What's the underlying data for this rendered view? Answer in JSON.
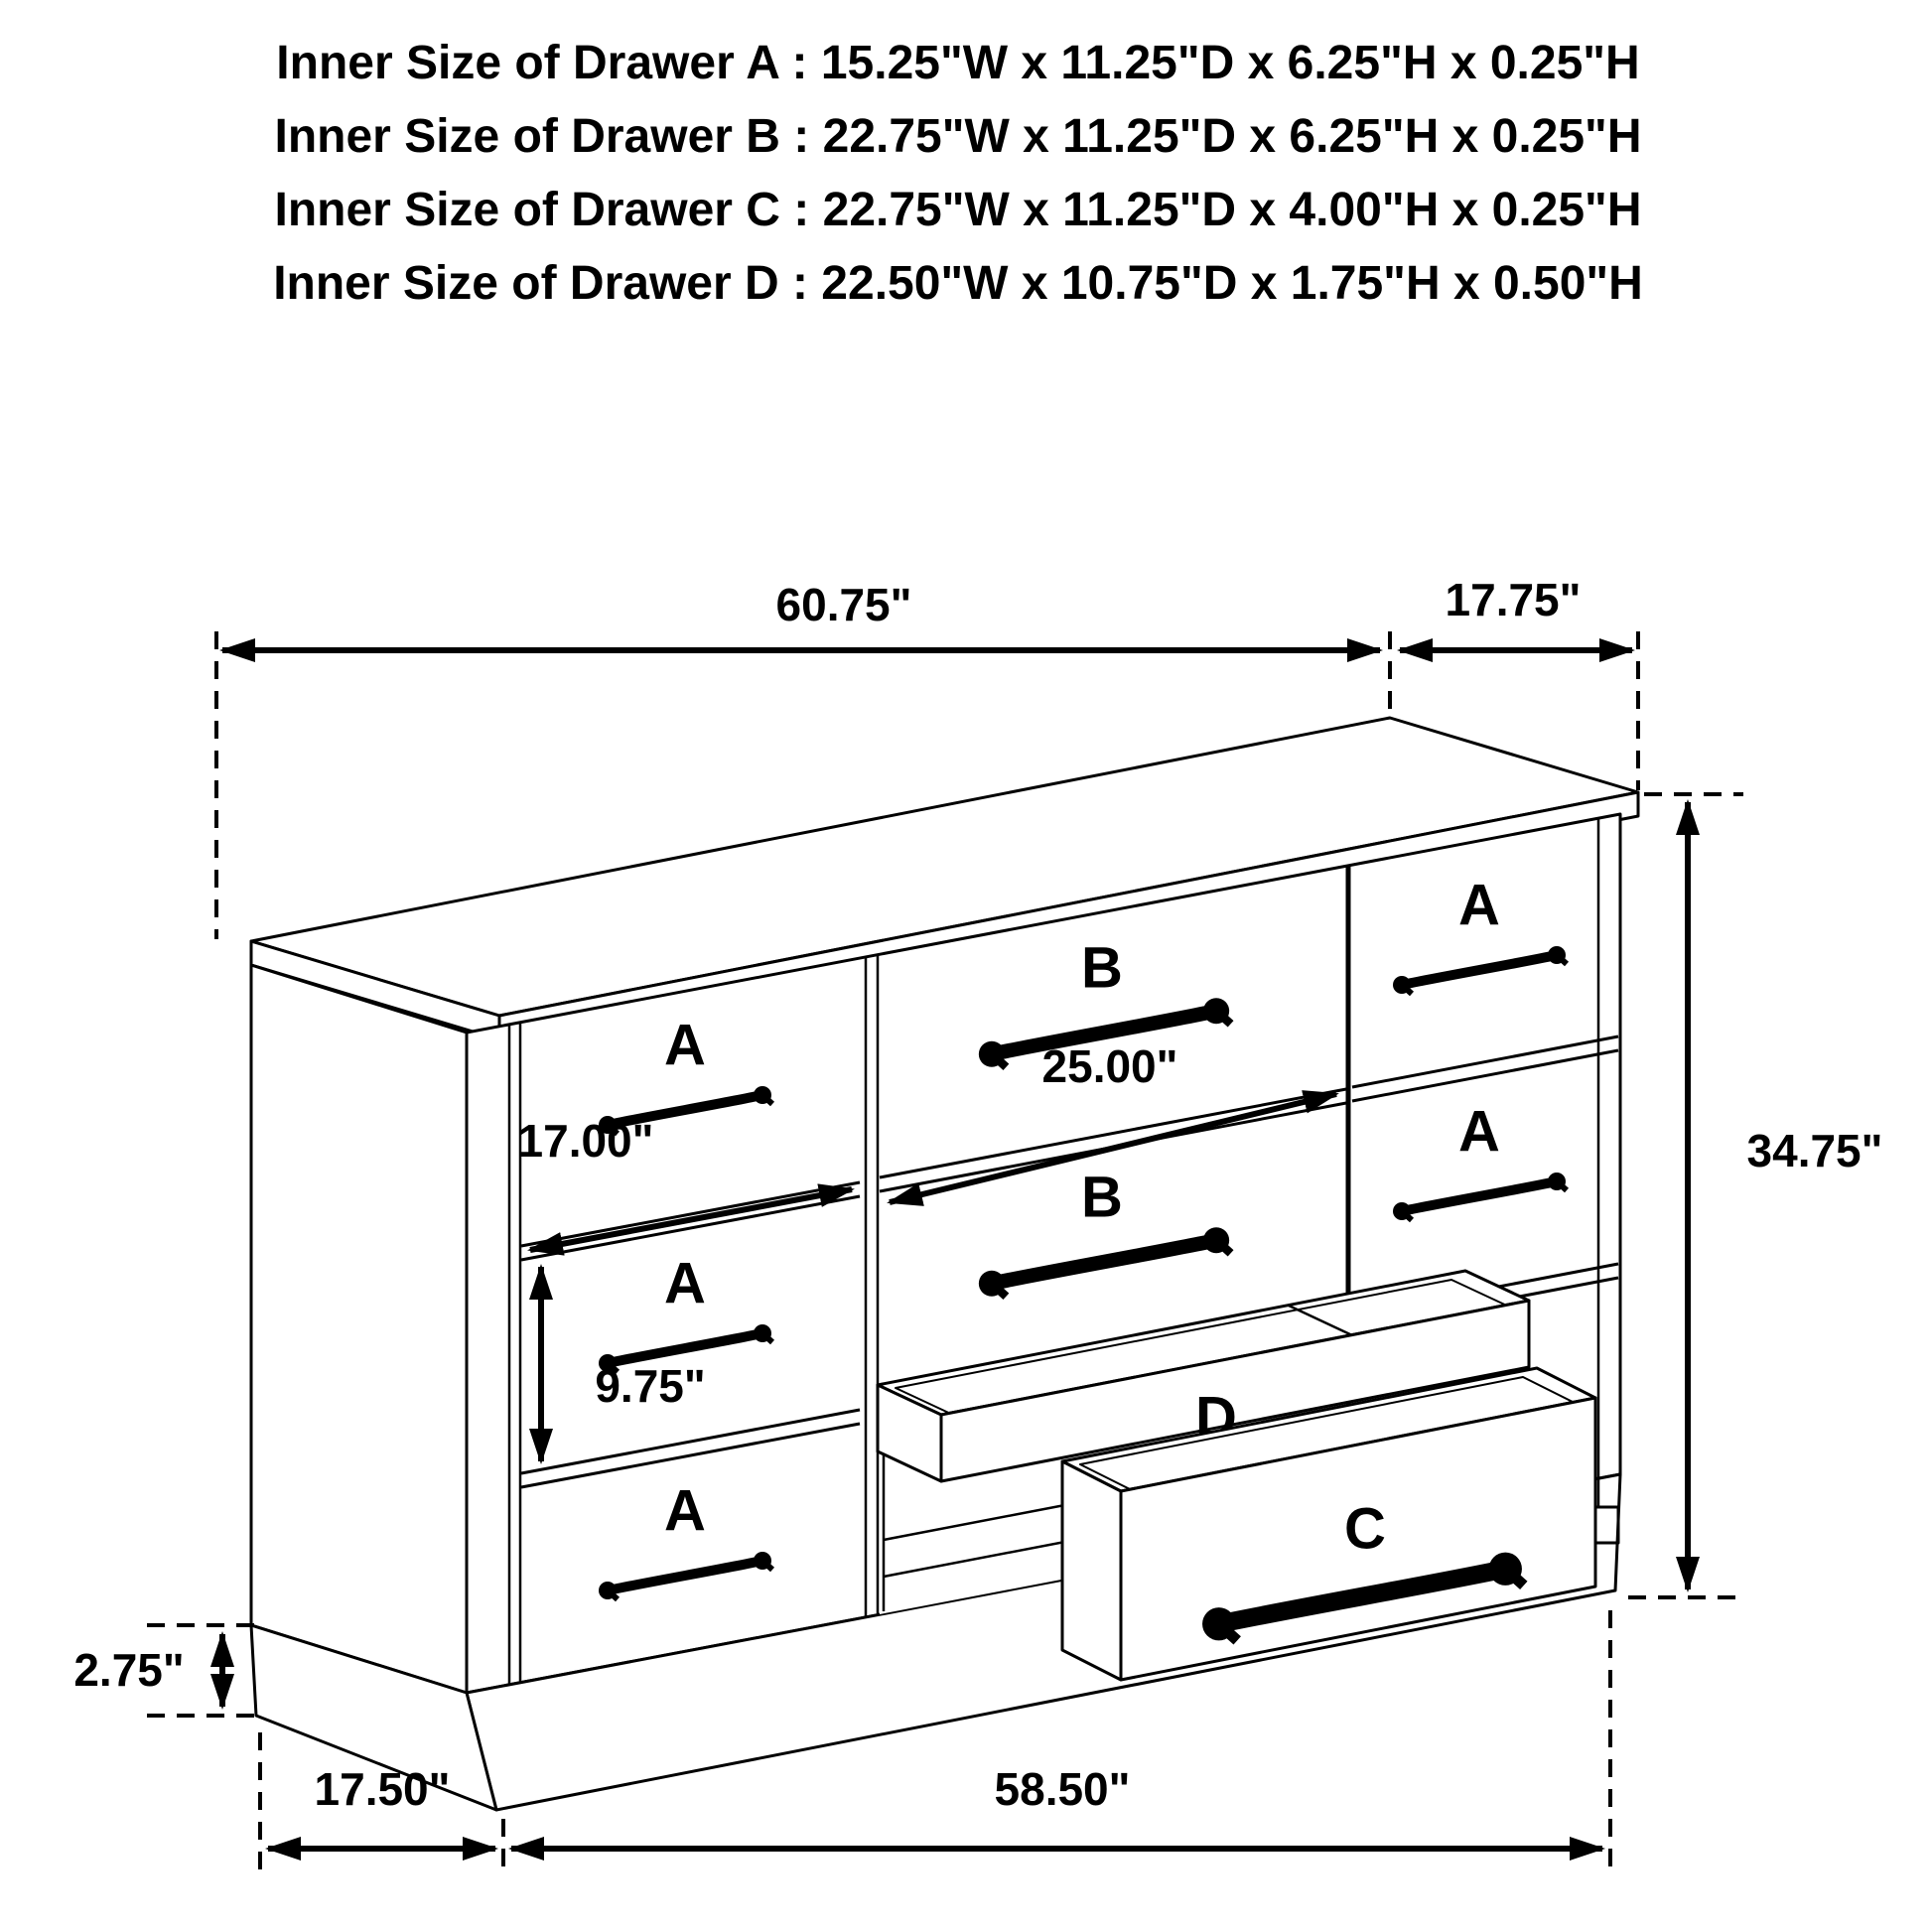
{
  "title": "Dresser drawer dimension diagram",
  "header": {
    "lines": [
      "Inner Size of Drawer A : 15.25\"W x 11.25\"D x 6.25\"H x 0.25\"H",
      "Inner Size of Drawer B : 22.75\"W x 11.25\"D x 6.25\"H x 0.25\"H",
      "Inner Size of Drawer C : 22.75\"W x 11.25\"D x 4.00\"H x 0.25\"H",
      "Inner Size of Drawer  D : 22.50\"W x 10.75\"D x 1.75\"H x 0.50\"H"
    ]
  },
  "labels": {
    "a": "A",
    "b": "B",
    "c": "C",
    "d": "D"
  },
  "dimensions": {
    "top_width": "60.75\"",
    "top_depth": "17.75\"",
    "height": "34.75\"",
    "drawer_a_width": "17.00\"",
    "drawer_b_width": "25.00\"",
    "drawer_a_height": "9.75\"",
    "base_height": "2.75\"",
    "base_depth": "17.50\"",
    "base_width": "58.50\""
  },
  "colors": {
    "line": "#000000",
    "label_red": "#e51b1b",
    "background": "#ffffff"
  }
}
